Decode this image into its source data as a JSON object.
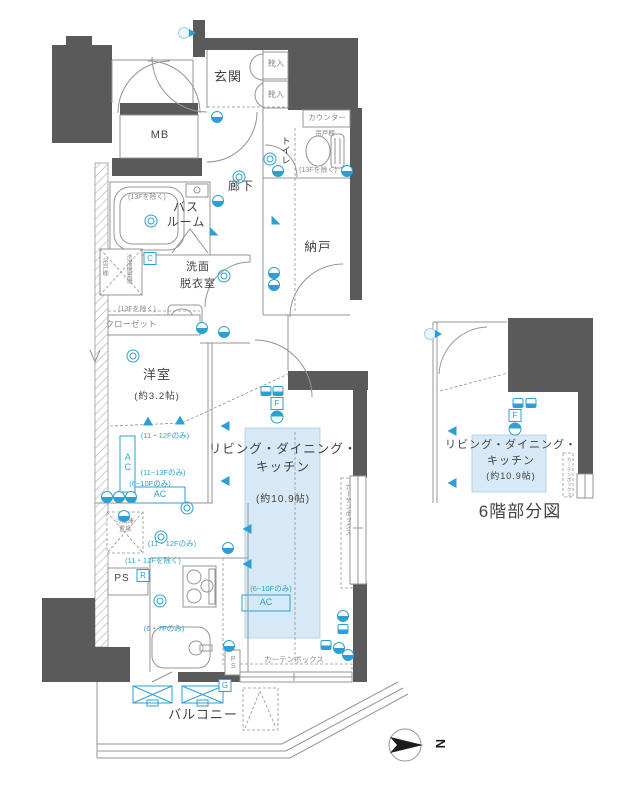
{
  "title": "マンション間取り図",
  "colors": {
    "wall": "#5a5a5a",
    "line": "#949494",
    "accent": "#2e9fd4",
    "shade": "#d7e9f6",
    "text": "#424242"
  },
  "compass": {
    "label": "N"
  },
  "partial_plan": {
    "caption": "6階部分図"
  },
  "rooms": {
    "entrance": "玄関",
    "shoe_box": "靴入",
    "meter_box": "MB",
    "toilet": "トイレ",
    "counter": "カウンター",
    "hanging_shelf": "吊戸棚",
    "corridor": "廊下",
    "storage": "納戸",
    "bathroom": "バスルーム",
    "washroom": "洗面脱衣室",
    "washer_place": "洗濯機置場",
    "closet": "クローゼット",
    "western_room": "洋室",
    "western_room_size": "約3.2帖",
    "ldk": "リビング・ダイニング・キッチン",
    "ldk_size": "約10.9帖",
    "fridge_place": "冷蔵庫置場",
    "pipe_space": "PS",
    "balcony": "バルコニー",
    "curtain_box": "カーテンボックス",
    "ac": "AC"
  },
  "notes": {
    "except_13f": "(13Fを除く)",
    "only_11_12f": "(11・12Fのみ)",
    "only_11_13f": "(11~13Fのみ)",
    "only_6_10f": "(6~10Fのみ)",
    "except_11_12f": "(11・12Fを除く)",
    "only_6_7f": "(6・7Fのみ)"
  },
  "labels": [
    {
      "n": "entrance",
      "t": "玄関",
      "x": 228,
      "y": 70,
      "s": 13,
      "c": "room"
    },
    {
      "n": "shoe-box-1",
      "t": "靴入",
      "x": 276,
      "y": 60,
      "s": 8,
      "c": "gray"
    },
    {
      "n": "shoe-box-2",
      "t": "靴入",
      "x": 276,
      "y": 91,
      "s": 8,
      "c": "gray"
    },
    {
      "n": "meter-box",
      "t": "MB",
      "x": 160,
      "y": 130,
      "s": 11,
      "c": "room"
    },
    {
      "n": "counter",
      "t": "カウンター",
      "x": 327,
      "y": 114,
      "s": 7.5,
      "c": "gray"
    },
    {
      "n": "hanging-shelf-toilet",
      "t": "吊戸棚",
      "x": 325,
      "y": 131,
      "s": 6.5,
      "c": "gray"
    },
    {
      "n": "note-13f-toilet",
      "t": "(13Fを除く)",
      "x": 318,
      "y": 167,
      "s": 7,
      "c": "gray"
    },
    {
      "n": "toilet",
      "t": "トイレ",
      "x": 284,
      "y": 136,
      "s": 9.5,
      "c": "room",
      "v": 1
    },
    {
      "n": "corridor",
      "t": "廊下",
      "x": 241,
      "y": 180,
      "s": 12,
      "c": "room"
    },
    {
      "n": "storage",
      "t": "納戸",
      "x": 318,
      "y": 241,
      "s": 12.5,
      "c": "room"
    },
    {
      "n": "bathroom-1",
      "t": "バス",
      "x": 186,
      "y": 201,
      "s": 12,
      "c": "room"
    },
    {
      "n": "bathroom-2",
      "t": "ルーム",
      "x": 186,
      "y": 216,
      "s": 12,
      "c": "room"
    },
    {
      "n": "note-13f-bath",
      "t": "(13Fを除く)",
      "x": 147,
      "y": 194,
      "s": 7,
      "c": "gray"
    },
    {
      "n": "washroom-1",
      "t": "洗面",
      "x": 198,
      "y": 262,
      "s": 11,
      "c": "room"
    },
    {
      "n": "washroom-2",
      "t": "脱衣室",
      "x": 198,
      "y": 279,
      "s": 11,
      "c": "room"
    },
    {
      "n": "hanging-shelf-left",
      "t": "吊戸棚",
      "x": 104,
      "y": 258,
      "s": 6,
      "c": "gray",
      "v": 1
    },
    {
      "n": "washer-place",
      "t": "洗濯機置場",
      "x": 128,
      "y": 254,
      "s": 6,
      "c": "gray",
      "v": 1
    },
    {
      "n": "note-13f-closet",
      "t": "(13Fを除く)",
      "x": 137,
      "y": 306,
      "s": 7,
      "c": "gray"
    },
    {
      "n": "closet",
      "t": "クローゼット",
      "x": 131,
      "y": 320,
      "s": 8.5,
      "c": "gray"
    },
    {
      "n": "western-room",
      "t": "洋室",
      "x": 157,
      "y": 368,
      "s": 13,
      "c": "room"
    },
    {
      "n": "western-room-size",
      "t": "(約3.2帖)",
      "x": 157,
      "y": 392,
      "s": 9.5,
      "c": "room"
    },
    {
      "n": "note-11-12-only-a",
      "t": "(11・12Fのみ)",
      "x": 165,
      "y": 432,
      "s": 7.5,
      "c": "blue"
    },
    {
      "n": "ac-1",
      "t": "AC",
      "x": 127,
      "y": 452,
      "s": 9,
      "c": "blue",
      "v": 1
    },
    {
      "n": "note-11-13-only",
      "t": "(11~13Fのみ)",
      "x": 163,
      "y": 469,
      "s": 7.5,
      "c": "blue"
    },
    {
      "n": "note-6-10-only-a",
      "t": "(6~10Fのみ)",
      "x": 150,
      "y": 480,
      "s": 7.5,
      "c": "blue"
    },
    {
      "n": "ac-2",
      "t": "AC",
      "x": 160,
      "y": 490,
      "s": 9,
      "c": "blue"
    },
    {
      "n": "fridge-1",
      "t": "冷蔵庫",
      "x": 125,
      "y": 519,
      "s": 6,
      "c": "gray"
    },
    {
      "n": "fridge-2",
      "t": "置場",
      "x": 125,
      "y": 527,
      "s": 6,
      "c": "gray"
    },
    {
      "n": "note-11-12-only-b",
      "t": "(11・12Fのみ)",
      "x": 172,
      "y": 540,
      "s": 7.5,
      "c": "blue"
    },
    {
      "n": "note-11-12-except",
      "t": "(11・12Fを除く)",
      "x": 153,
      "y": 557,
      "s": 7.5,
      "c": "blue"
    },
    {
      "n": "pipe-space-1",
      "t": "PS",
      "x": 122,
      "y": 574,
      "s": 10,
      "c": "room"
    },
    {
      "n": "note-6-7-only",
      "t": "(6・7Fのみ)",
      "x": 164,
      "y": 625,
      "s": 7.5,
      "c": "blue"
    },
    {
      "n": "ldk-1",
      "t": "リビング・ダイニング・",
      "x": 283,
      "y": 443,
      "s": 12.5,
      "c": "room"
    },
    {
      "n": "ldk-2",
      "t": "キッチン",
      "x": 283,
      "y": 461,
      "s": 12.5,
      "c": "room"
    },
    {
      "n": "ldk-size",
      "t": "(約10.9帖)",
      "x": 283,
      "y": 495,
      "s": 10,
      "c": "room"
    },
    {
      "n": "note-6-10-only-b",
      "t": "(6~10Fのみ)",
      "x": 271,
      "y": 585,
      "s": 7.5,
      "c": "blue"
    },
    {
      "n": "ac-3",
      "t": "AC",
      "x": 266,
      "y": 598,
      "s": 9,
      "c": "blue"
    },
    {
      "n": "curtain-box-v",
      "t": "カーテンボックス",
      "x": 346,
      "y": 484,
      "s": 6.5,
      "c": "gray",
      "v": 1
    },
    {
      "n": "curtain-box-h",
      "t": "カーテンボックス",
      "x": 294,
      "y": 656,
      "s": 7.5,
      "c": "gray"
    },
    {
      "n": "pipe-space-2",
      "t": "PS",
      "x": 233,
      "y": 656,
      "s": 7,
      "c": "gray",
      "v": 1
    },
    {
      "n": "balcony",
      "t": "バルコニー",
      "x": 203,
      "y": 708,
      "s": 13,
      "c": "room"
    },
    {
      "n": "sub-ldk-1",
      "t": "リビング・ダイニング・",
      "x": 511,
      "y": 440,
      "s": 11,
      "c": "room"
    },
    {
      "n": "sub-ldk-2",
      "t": "キッチン",
      "x": 511,
      "y": 456,
      "s": 11,
      "c": "room"
    },
    {
      "n": "sub-ldk-size",
      "t": "(約10.9帖)",
      "x": 511,
      "y": 472,
      "s": 9,
      "c": "room"
    },
    {
      "n": "sub-curtain-box",
      "t": "カーテンボックス",
      "x": 568,
      "y": 457,
      "s": 5,
      "c": "gray",
      "v": 1
    },
    {
      "n": "sub-caption",
      "t": "6階部分図",
      "x": 520,
      "y": 503,
      "s": 17,
      "c": "room"
    }
  ],
  "letter_tags": [
    {
      "t": "C",
      "x": 150,
      "y": 252
    },
    {
      "t": "R",
      "x": 143,
      "y": 569
    },
    {
      "t": "G",
      "x": 225,
      "y": 679
    },
    {
      "t": "F",
      "x": 277,
      "y": 397
    },
    {
      "t": "F",
      "x": 515,
      "y": 409
    }
  ],
  "icons": [
    {
      "t": "doorbell",
      "x": 184,
      "y": 33
    },
    {
      "t": "doorbell",
      "x": 430,
      "y": 334
    },
    {
      "t": "outlet",
      "x": 217,
      "y": 117
    },
    {
      "t": "outlet",
      "x": 278,
      "y": 171
    },
    {
      "t": "outlet",
      "x": 347,
      "y": 171
    },
    {
      "t": "outlet",
      "x": 218,
      "y": 201
    },
    {
      "t": "outlet",
      "x": 274,
      "y": 273
    },
    {
      "t": "outlet",
      "x": 274,
      "y": 285
    },
    {
      "t": "outlet",
      "x": 202,
      "y": 328
    },
    {
      "t": "outlet",
      "x": 224,
      "y": 332
    },
    {
      "t": "outlet",
      "x": 107,
      "y": 497
    },
    {
      "t": "outlet",
      "x": 119,
      "y": 497
    },
    {
      "t": "outlet",
      "x": 131,
      "y": 497
    },
    {
      "t": "outlet",
      "x": 124,
      "y": 516
    },
    {
      "t": "outlet",
      "x": 228,
      "y": 548
    },
    {
      "t": "outlet",
      "x": 229,
      "y": 646
    },
    {
      "t": "outlet",
      "x": 343,
      "y": 616
    },
    {
      "t": "outlet",
      "x": 339,
      "y": 648
    },
    {
      "t": "outlet",
      "x": 348,
      "y": 655
    },
    {
      "t": "ceiling-light",
      "x": 239,
      "y": 177
    },
    {
      "t": "ceiling-light",
      "x": 151,
      "y": 221
    },
    {
      "t": "ceiling-light",
      "x": 270,
      "y": 159
    },
    {
      "t": "ceiling-light",
      "x": 224,
      "y": 276
    },
    {
      "t": "ceiling-light",
      "x": 133,
      "y": 356
    },
    {
      "t": "ceiling-light",
      "x": 187,
      "y": 508
    },
    {
      "t": "ceiling-light",
      "x": 161,
      "y": 537
    },
    {
      "t": "ceiling-light",
      "x": 160,
      "y": 601
    },
    {
      "t": "speaker",
      "x": 148,
      "y": 421,
      "r": 90
    },
    {
      "t": "speaker",
      "x": 180,
      "y": 420,
      "r": 90
    },
    {
      "t": "speaker",
      "x": 225,
      "y": 426
    },
    {
      "t": "speaker",
      "x": 225,
      "y": 481
    },
    {
      "t": "speaker",
      "x": 247,
      "y": 529
    },
    {
      "t": "speaker",
      "x": 247,
      "y": 564
    },
    {
      "t": "speaker",
      "x": 452,
      "y": 431
    },
    {
      "t": "speaker",
      "x": 452,
      "y": 483
    },
    {
      "t": "vent",
      "x": 214,
      "y": 231
    },
    {
      "t": "vent",
      "x": 276,
      "y": 220
    },
    {
      "t": "wall-unit",
      "x": 266,
      "y": 391
    },
    {
      "t": "wall-unit",
      "x": 278,
      "y": 391
    },
    {
      "t": "wall-unit",
      "x": 518,
      "y": 403
    },
    {
      "t": "wall-unit",
      "x": 531,
      "y": 403
    },
    {
      "t": "wall-unit",
      "x": 343,
      "y": 629
    },
    {
      "t": "wall-unit",
      "x": 326,
      "y": 645
    },
    {
      "t": "circleT",
      "x": 277,
      "y": 417
    },
    {
      "t": "circleT",
      "x": 515,
      "y": 429
    }
  ]
}
